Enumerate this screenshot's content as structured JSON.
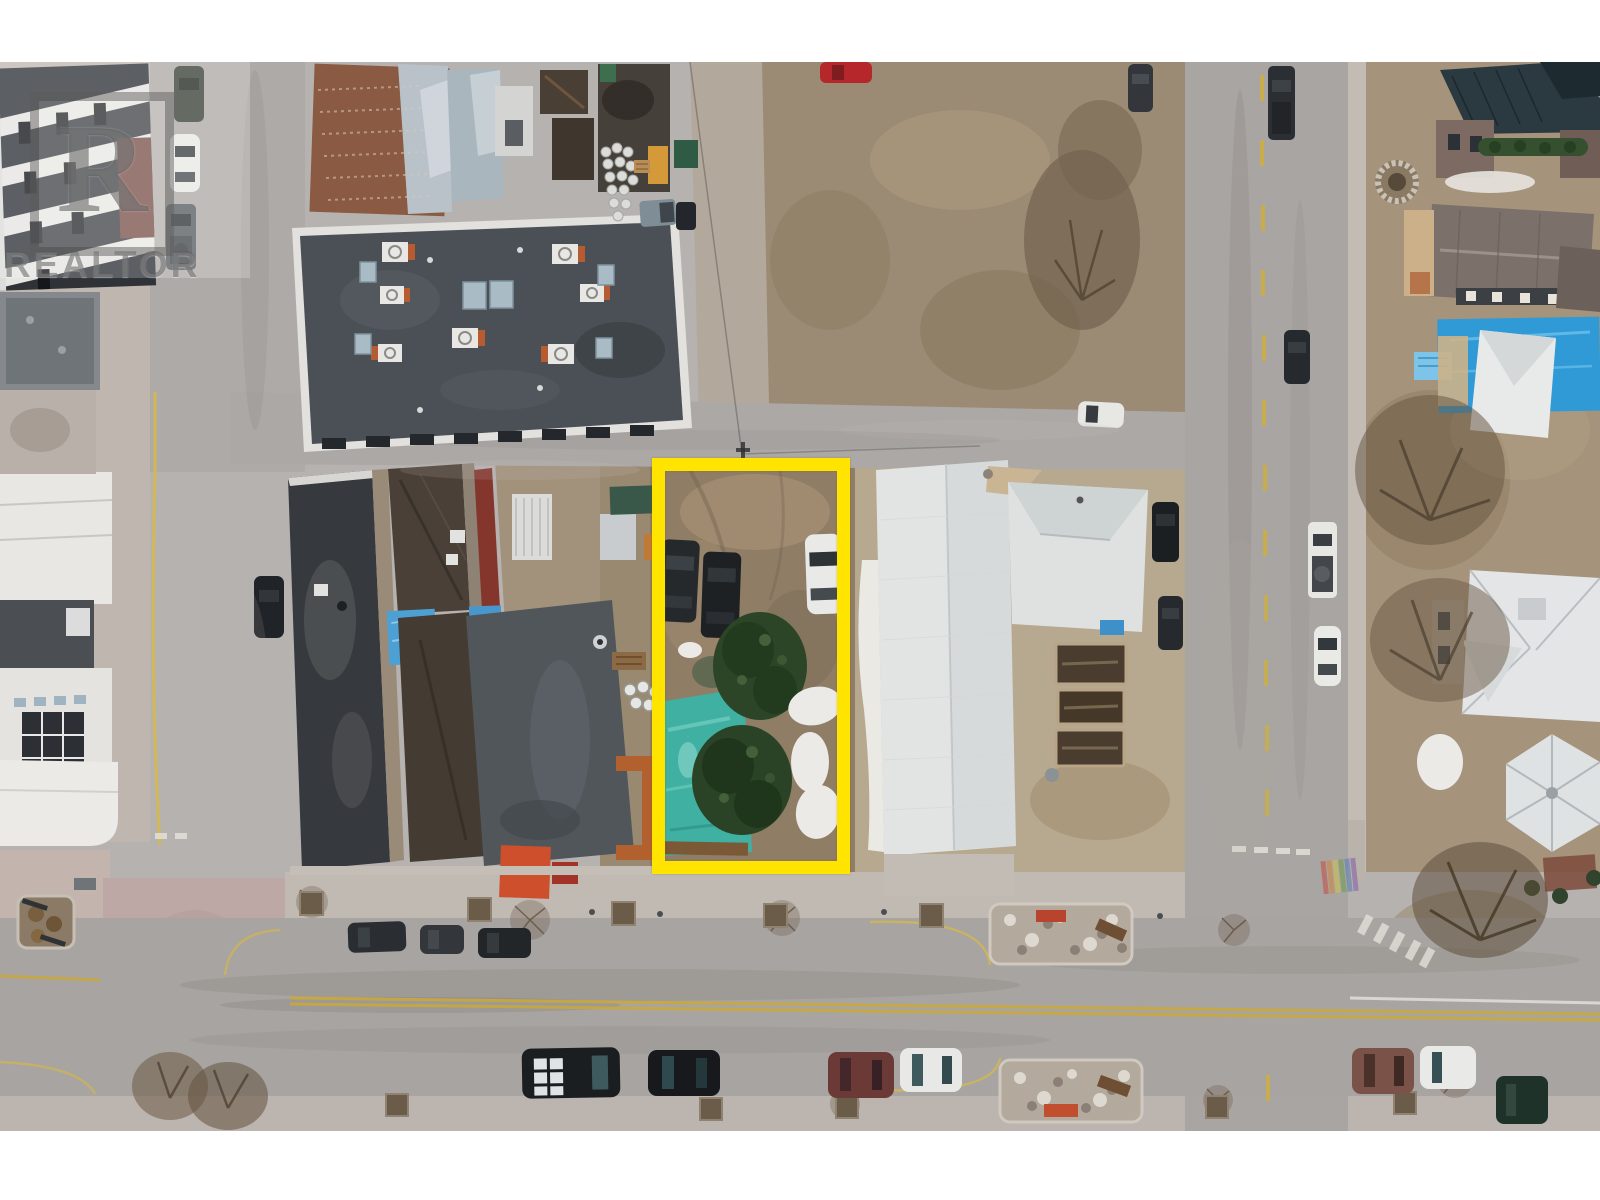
{
  "image": {
    "type": "aerial-drone-photograph",
    "description": "Top-down aerial view of a downtown block with a vacant corner lot outlined in yellow, surrounded by commercial buildings, a white church hall, houses, streets and parked cars; early spring with patches of snow.",
    "letterbox": {
      "top_band_px": 62,
      "bottom_band_px": 69,
      "band_color": "#ffffff"
    }
  },
  "watermark": {
    "logo_letter": "R",
    "label": "REALTOR",
    "style": "translucent gray block-R logo with wordmark, top-left corner"
  },
  "highlight": {
    "purpose": "property-boundary",
    "shape": "rectangle",
    "color": "#ffe400"
  },
  "scene": {
    "colors": {
      "pavement": "#b6b2af",
      "asphalt": "#a8a4a1",
      "plaza_mauve": "#bda8a5",
      "yard_brown": "#9c8b74",
      "lot_dirt": "#8f7d66",
      "roof_charcoal": "#4b5056",
      "roof_dark": "#36393d",
      "roof_white": "#e2e4e4",
      "tarp_blue": "#2f9ad6",
      "pool_teal": "#3fb0a2",
      "bush_green": "#2c4527",
      "snow": "#eceae6",
      "bench_orange": "#c14e2e",
      "curb_yellow": "#d9b946",
      "brick_red": "#84362c"
    },
    "objects": [
      "vacant lot with dirt, two dark SUVs, one white car, two large evergreen bushes, teal pool/tarp, snow patches",
      "flat-roof commercial building with HVAC units and skylights",
      "bar/restaurant complex with dark roofs, blue tarps and orange patio planters",
      "white metal-roof church hall with raised garden beds",
      "modern condo building top-left and white modern offices left",
      "houses with gray, rusty-metal, blue-tarp and dark roofs along right street",
      "ornate white Victorian house bottom-right",
      "main street with double yellow line, parked cars, stone planters with orange benches",
      "rainbow crosswalk at right intersection",
      "bare winter trees and green hedge"
    ]
  }
}
